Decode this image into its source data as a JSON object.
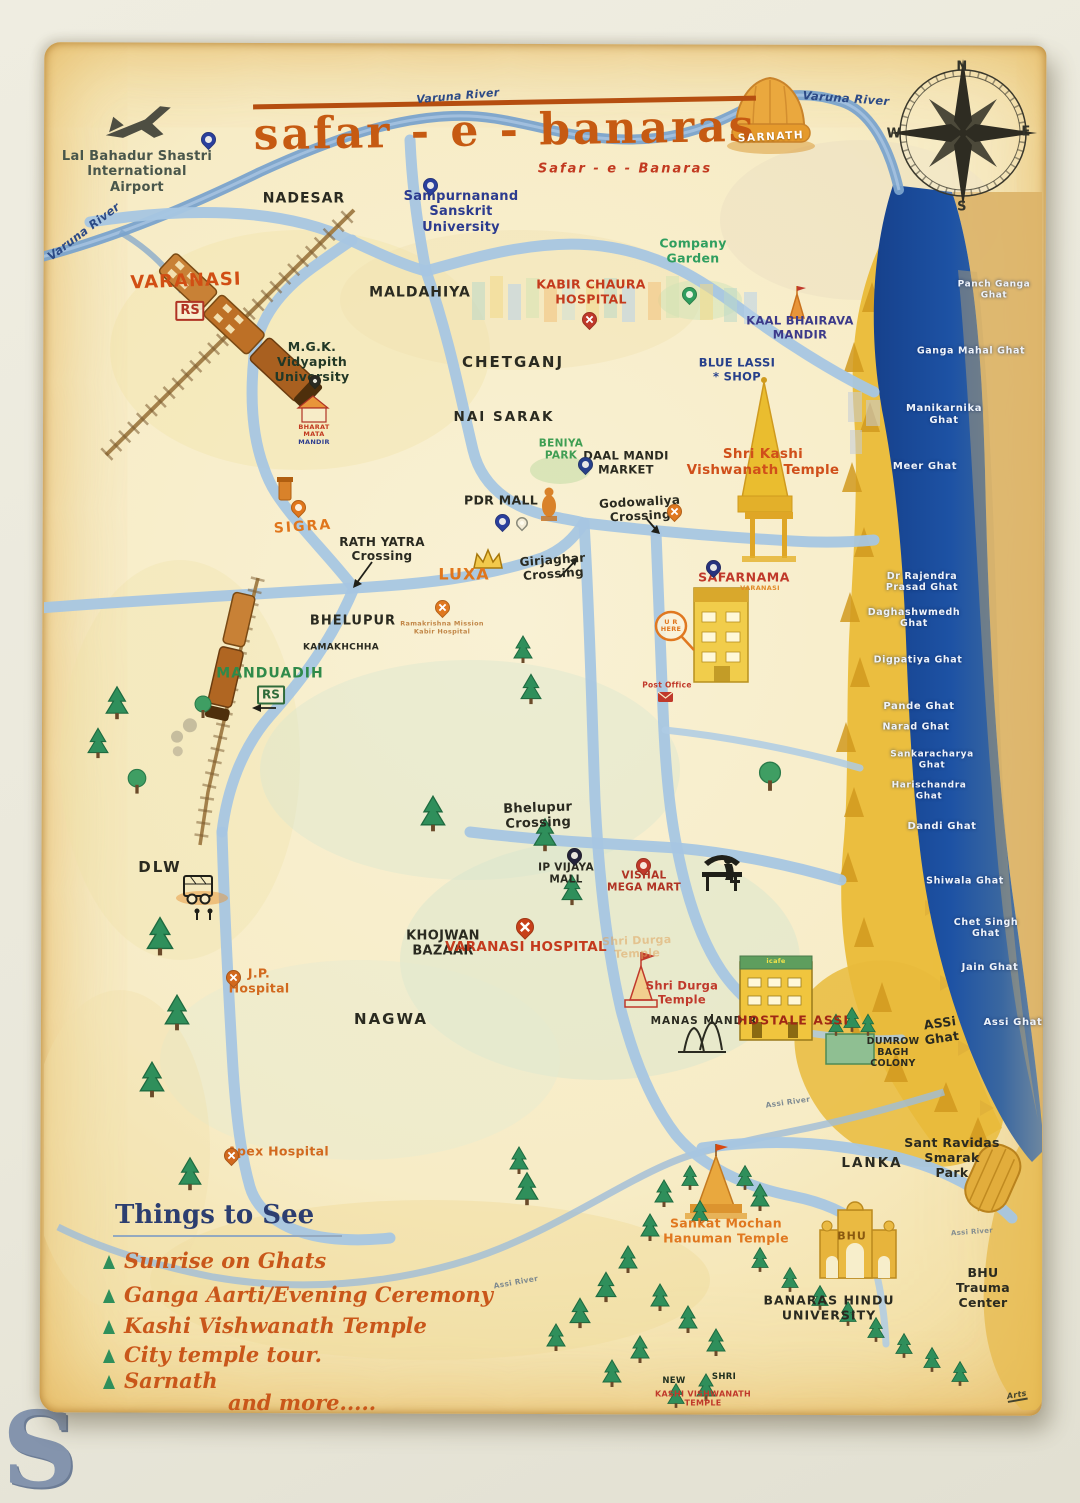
{
  "photo": {
    "watermark": "S"
  },
  "title": {
    "main": "safar - e - banaras",
    "sub": "Safar - e - Banaras"
  },
  "compass": {
    "n": "N",
    "e": "E",
    "s": "S",
    "w": "W"
  },
  "rivers": {
    "varuna_left": "Varuna River",
    "varuna_top": "Varuna River",
    "varuna_right": "Varuna River",
    "assi_a": "Assi River",
    "assi_b": "Assi River",
    "assi_c": "Assi River"
  },
  "places": {
    "airport": "Lal Bahadur Shastri\nInternational\nAirport",
    "nadesar": "NADESAR",
    "varanasi_rs": "VARANASI",
    "varanasi_rs_badge": "RS",
    "sampurnanand": "Sampurnanand\nSanskrit\nUniversity",
    "maldahiya": "MALDAHIYA",
    "company_garden": "Company\nGarden",
    "kabir_chaura": "KABIR CHAURA\nHOSPITAL",
    "kaal_bhairava": "KAAL BHAIRAVA\nMANDIR",
    "chetganj": "CHETGANJ",
    "mgk": "M.G.K.\nVidyapith\nUniversity",
    "bharat_mata_top": "BHARAT\nMATA",
    "bharat_mata_bottom": "MANDIR",
    "nai_sarak": "NAI SARAK",
    "blue_lassi": "BLUE LASSI\n* SHOP",
    "kashi_vishwanath": "Shri Kashi\nVishwanath Temple",
    "beniya_park": "BENIYA\nPARK",
    "daal_mandi": "DAAL MANDI\nMARKET",
    "pdr_mall": "PDR MALL",
    "godowaliya": "Godowaliya\nCrossing",
    "girjaghar": "Girjaghar\nCrossing",
    "rath_yatra": "RATH YATRA\nCrossing",
    "sigra": "SIGRA",
    "luxa": "LUXA",
    "sarnath": "SARNATH",
    "bhelupur": "BHELUPUR",
    "kamakhchha": "KAMAKHCHHA",
    "manduadih": "MANDUADIH",
    "manduadih_badge": "RS",
    "rk_mission": "Ramakrishna Mission\nKabir Hospital",
    "safarnama": "SAFARNAMA",
    "safarnama_sub": "VARANASI",
    "u_r_here": "U R\nHERE",
    "post_office": "Post Office",
    "dlw": "DLW",
    "jp_hospital": "J.P.\nHospital",
    "apex_hospital": "Apex Hospital",
    "bhelupur_crossing": "Bhelupur\nCrossing",
    "ip_vijaya": "IP VIJAYA\nMALL",
    "vishal": "VISHAL\nMEGA MART",
    "khojwan": "KHOJWAN\nBAZAAR",
    "varanasi_hospital": "VARANASI HOSPITAL",
    "nagwa": "NAGWA",
    "shri_durga_faint": "Shri Durga\nTemple",
    "shri_durga": "Shri Durga\nTemple",
    "manas_mandir": "MANAS  MANDIR",
    "hostale_assi": "HOSTALE  ASSI",
    "hostale_band": "icafe",
    "dumrow": "DUMROW\nBAGH\nCOLONY",
    "assi_ghat_land": "ASSi\nGhat",
    "lanka": "LANKA",
    "sant_ravidas": "Sant Ravidas\nSmarak\nPark",
    "sankat_mochan": "Sankat Mochan\nHanuman Temple",
    "bhu_gate": "BHU",
    "bhu": "BANARAS  HINDU\nUNIVERSITY",
    "trauma": "BHU\nTrauma Center",
    "new_kashi_a": "NEW",
    "new_kashi_b": "SHRI",
    "new_kashi_c": "KASHI VISHWANATH\nTEMPLE",
    "signature": "Arts"
  },
  "ghats": [
    "Panch Ganga Ghat",
    "Ganga Mahal Ghat",
    "Manikarnika\nGhat",
    "Meer Ghat",
    "Dr Rajendra\nPrasad Ghat",
    "Daghashwmedh\nGhat",
    "Digpatiya Ghat",
    "Pande Ghat",
    "Narad Ghat",
    "Sankaracharya\nGhat",
    "Harischandra\nGhat",
    "Dandi Ghat",
    "Shiwala Ghat",
    "Chet Singh Ghat",
    "Jain Ghat",
    "Assi Ghat"
  ],
  "things_to_see": {
    "heading": "Things to See",
    "items": [
      "Sunrise on Ghats",
      "Ganga Aarti/Evening Ceremony",
      "Kashi Vishwanath Temple",
      "City temple tour.",
      "Sarnath"
    ],
    "more": "and more....."
  }
}
